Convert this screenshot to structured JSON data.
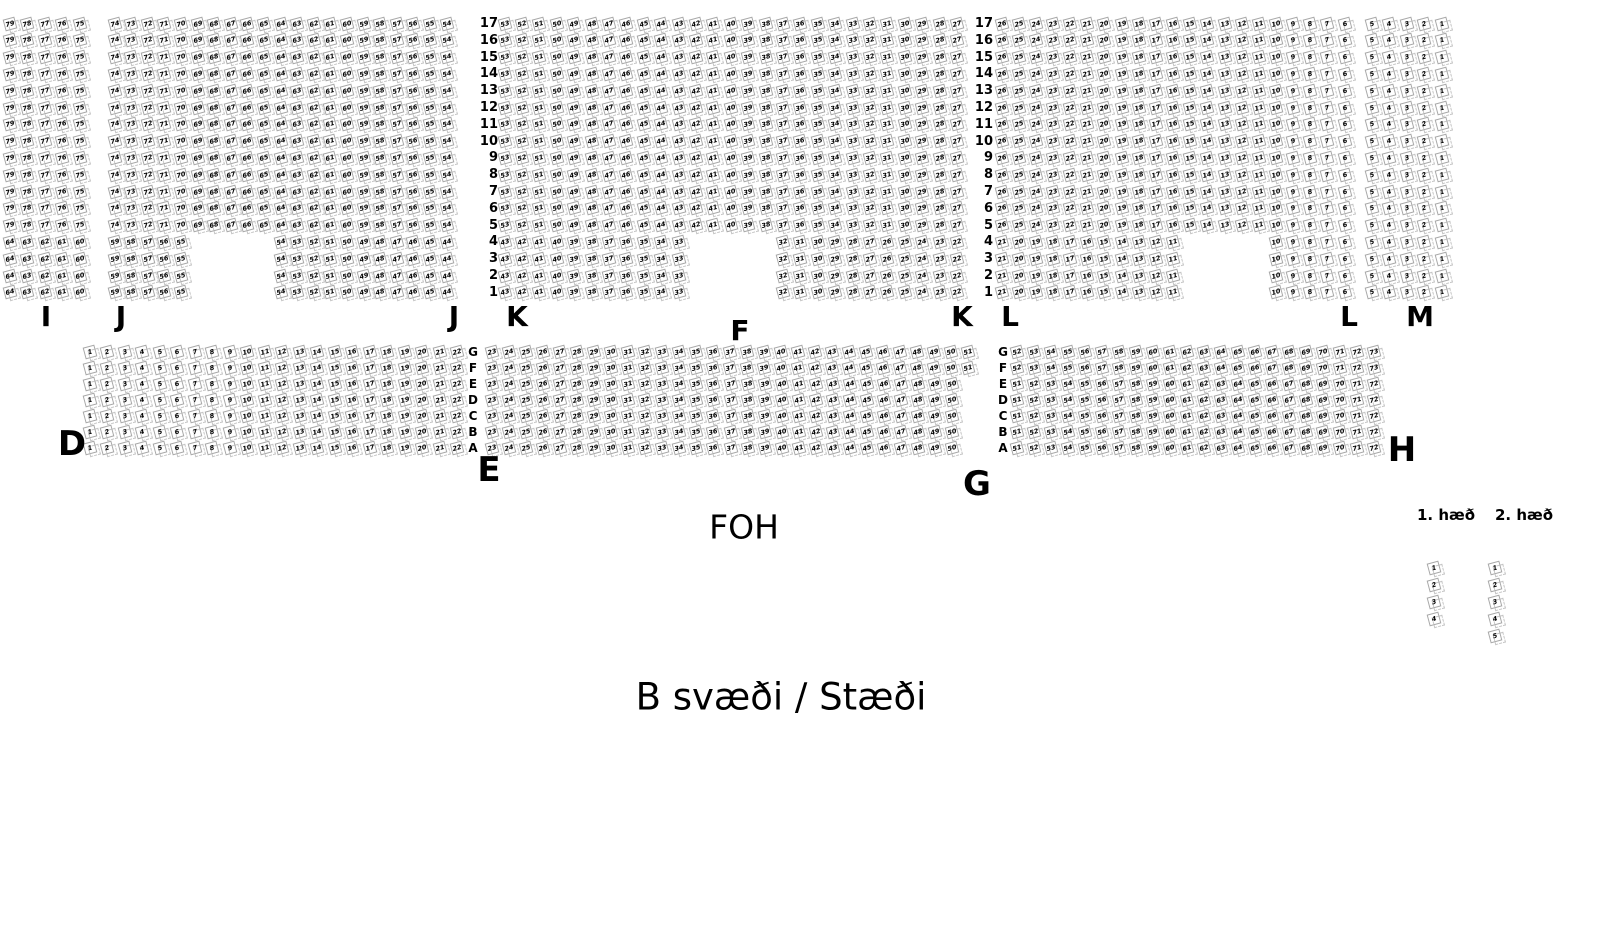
{
  "title": "B svæði / Stæði",
  "foh_label": "FOH",
  "colors": {
    "background": "#ffffff",
    "seat_border": "#a9a9a9",
    "seat_ghost_border": "#c6c6c6",
    "text": "#000000"
  },
  "legend": {
    "label_y": 515,
    "seats_y_start": 568,
    "seat_step": 17,
    "columns": [
      {
        "label": "1. hæð",
        "label_x": 1446,
        "seat_x": 1434,
        "seats": [
          1,
          2,
          3,
          4
        ]
      },
      {
        "label": "2. hæð",
        "label_x": 1524,
        "seat_x": 1495,
        "seats": [
          1,
          2,
          3,
          4,
          5
        ]
      }
    ]
  },
  "top_block": {
    "rows": [
      17,
      16,
      15,
      14,
      13,
      12,
      11,
      10,
      9,
      8,
      7,
      6,
      5,
      4,
      3,
      2,
      1
    ],
    "row_y_start": 24,
    "row_y_step": 16.8,
    "full_rows_from": 5,
    "numbering_direction": "right_to_left_descending",
    "number_columns": [
      {
        "x_right": 498
      },
      {
        "x_right": 993
      }
    ],
    "sections": [
      {
        "name": "I",
        "x0": 10,
        "dx": 17.5,
        "cols": 5,
        "full_start": 79,
        "short_rows": [
          {
            "col": 0,
            "count": 5,
            "start": 64
          }
        ]
      },
      {
        "name": "J",
        "x0": 115,
        "dx": 16.6,
        "cols": 21,
        "full_start": 74,
        "short_rows": [
          {
            "col": 0,
            "count": 5,
            "start": 59
          },
          {
            "col": 10,
            "count": 11,
            "start": 54
          }
        ]
      },
      {
        "name": "K-F-K",
        "x0": 505,
        "dx": 17.4,
        "cols": 27,
        "full_start": 53,
        "short_rows": [
          {
            "col": 0,
            "count": 11,
            "start": 43
          },
          {
            "col": 16,
            "count": 11,
            "start": 32
          }
        ]
      },
      {
        "name": "L",
        "x0": 1002,
        "dx": 17.15,
        "cols": 21,
        "full_start": 26,
        "short_rows": [
          {
            "col": 0,
            "count": 11,
            "start": 21
          },
          {
            "col": 16,
            "count": 5,
            "start": 10
          }
        ]
      },
      {
        "name": "M",
        "x0": 1372,
        "dx": 17.5,
        "cols": 5,
        "full_start": 5,
        "short_rows": [
          {
            "col": 0,
            "count": 5,
            "start": 5
          }
        ]
      }
    ]
  },
  "bottom_block": {
    "rows": [
      "G",
      "F",
      "E",
      "D",
      "C",
      "B",
      "A"
    ],
    "row_y_start": 352,
    "row_y_step": 16,
    "numbering_direction": "left_to_right_ascending",
    "letter_columns": [
      {
        "x": 473
      },
      {
        "x": 1003
      }
    ],
    "sections": [
      {
        "name": "D",
        "x0": 90,
        "all_rows": {
          "start": 1,
          "count": 22,
          "dx": 17.5
        }
      },
      {
        "name": "E",
        "x0": 492,
        "rows_gf": {
          "start": 23,
          "count": 29,
          "dx": 17.0
        },
        "rows_ea": {
          "start": 23,
          "count": 28,
          "dx": 17.07
        }
      },
      {
        "name": "G",
        "x0": 1017,
        "rows_gf": {
          "start": 52,
          "count": 22,
          "dx": 17.0
        },
        "rows_ea": {
          "start": 51,
          "count": 22,
          "dx": 17.0
        }
      }
    ]
  },
  "section_labels": [
    {
      "text": "I",
      "x": 46,
      "y": 317,
      "size": 28
    },
    {
      "text": "J",
      "x": 121,
      "y": 317,
      "size": 28
    },
    {
      "text": "J",
      "x": 454,
      "y": 317,
      "size": 28
    },
    {
      "text": "K",
      "x": 517,
      "y": 317,
      "size": 28
    },
    {
      "text": "F",
      "x": 740,
      "y": 331,
      "size": 28
    },
    {
      "text": "K",
      "x": 962,
      "y": 317,
      "size": 28
    },
    {
      "text": "L",
      "x": 1010,
      "y": 317,
      "size": 28
    },
    {
      "text": "L",
      "x": 1349,
      "y": 317,
      "size": 28
    },
    {
      "text": "M",
      "x": 1420,
      "y": 317,
      "size": 28
    },
    {
      "text": "D",
      "x": 72,
      "y": 444,
      "size": 34
    },
    {
      "text": "E",
      "x": 489,
      "y": 470,
      "size": 34
    },
    {
      "text": "G",
      "x": 977,
      "y": 484,
      "size": 34
    },
    {
      "text": "H",
      "x": 1402,
      "y": 450,
      "size": 34
    }
  ],
  "foh": {
    "x": 744,
    "y": 527,
    "size": 33
  },
  "title_pos": {
    "x": 781,
    "y": 697,
    "size": 37
  }
}
